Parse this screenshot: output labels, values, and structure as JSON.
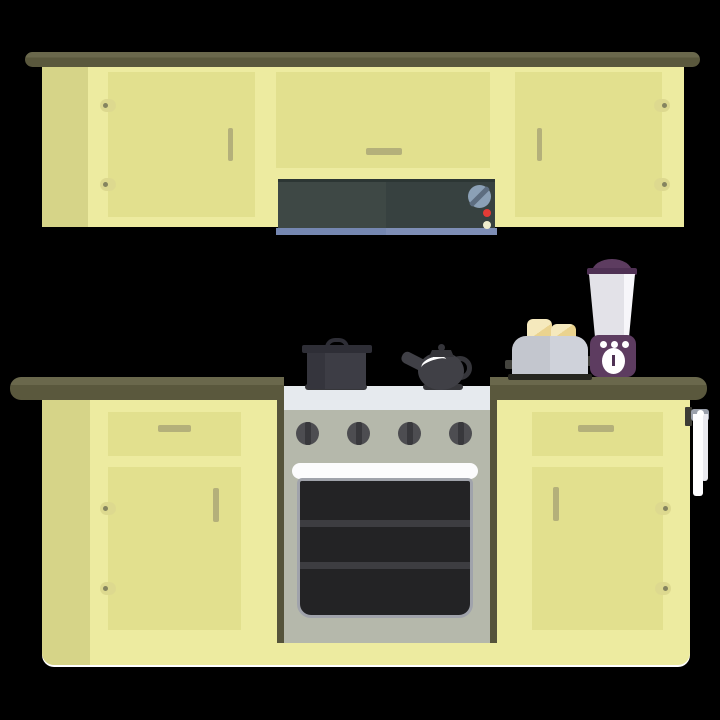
{
  "scene": {
    "label": "Flat design kitchen illustration",
    "background": "#000000"
  },
  "objects": [
    "top-shelf-board",
    "upper-cabinet-run",
    "upper-cabinet-door-left",
    "upper-cabinet-door-middle",
    "upper-cabinet-door-right",
    "range-hood",
    "hood-control-knob",
    "hood-indicator-lights",
    "countertop",
    "lower-cabinet-run",
    "drawer-left",
    "drawer-right",
    "cabinet-door-lower-left",
    "cabinet-door-lower-right",
    "stove-oven",
    "stove-burner-knobs",
    "oven-door-window",
    "cooking-pot",
    "tea-kettle",
    "toaster",
    "bread-slices",
    "blender",
    "hand-towel-rail"
  ],
  "palette": {
    "bg": "#000000",
    "shelfHi": "#6a684c",
    "shelf": "#5a583d",
    "body": "#edeba0",
    "inset": "#e2e08e",
    "side": "#d6d488",
    "handle": "#b4b07a",
    "hingePill": "#ddd98f",
    "hingeDot": "#85845f",
    "hoodL": "#3e4845",
    "hoodR": "#374140",
    "hoodTopEdge": "#2c3634",
    "stripL": "#7587b1",
    "stripR": "#7e8eb6",
    "hoodKnob": "#8ba0b6",
    "hoodKnobStripe": "#5d6d80",
    "ledRed": "#e33b36",
    "ledYellow": "#eeeccd",
    "stoveEdge": "#55533a",
    "stoveTop": "#e6eaee",
    "stoveBody": "#b5b8ab",
    "stoveKnob": "#4d4d51",
    "stoveKnobStripe": "#38383c",
    "ovenHandle": "#fcfcfd",
    "ovenBezel": "#a0a3ab",
    "ovenGlass": "#232325",
    "ovenRack": "#3d3d41",
    "burner": "#36363a",
    "potBody": "#3d3d45",
    "potShade": "#35353d",
    "potLid": "#2e2e36",
    "kettle": "#404046",
    "kettleDark": "#35353a",
    "toasterL": "#c3c6ce",
    "toasterR": "#cfd2da",
    "toasterBase": "#26261f",
    "lever": "#44443e",
    "bread": "#ead38f",
    "breadLight": "#f5e9bd",
    "blender": "#5d3c60",
    "blenderDark": "#4f3154",
    "jar": "#e3e2e8",
    "jarHi": "#f7f6fa",
    "towel": "#fdfdff",
    "towel2": "#e9e9ef",
    "rail": "#9aa0ab",
    "bracket": "#3c3c35",
    "white": "#ffffff"
  }
}
